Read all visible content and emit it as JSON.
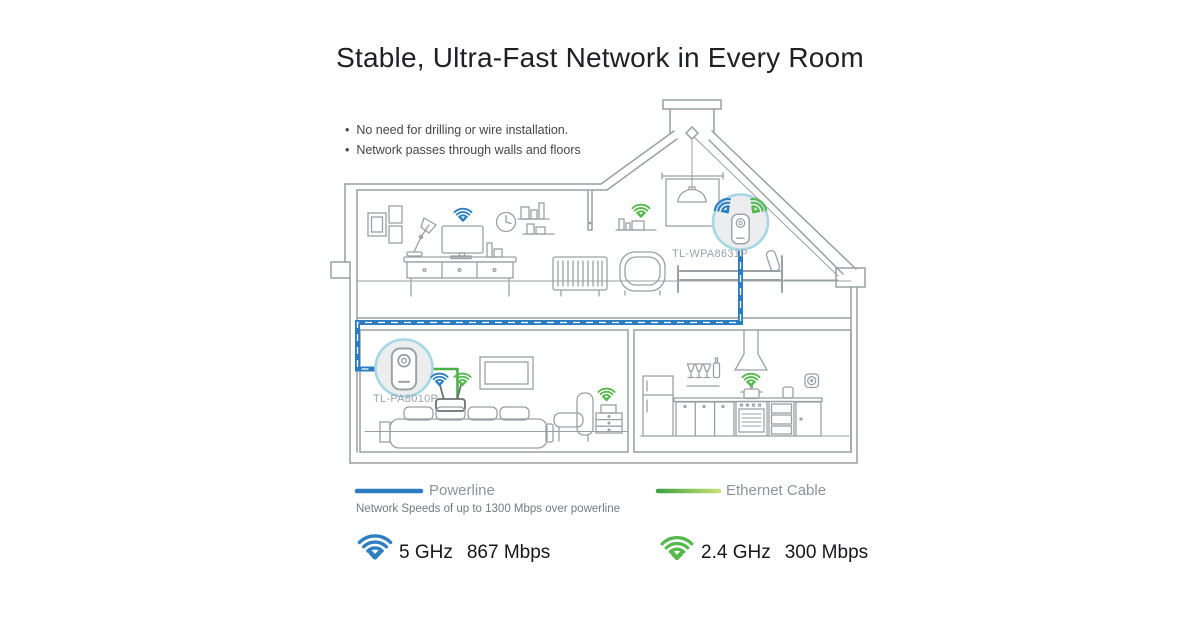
{
  "title": "Stable, Ultra-Fast Network in Every Room",
  "bullets": [
    "No need for drilling or wire installation.",
    "Network passes through walls and floors"
  ],
  "house": {
    "attic_device_label": "TL-WPA8631P",
    "bedroom_device_label": "TL-PA8010P"
  },
  "legend": {
    "powerline_label": "Powerline",
    "powerline_note": "Network Speeds of up to 1300 Mbps over powerline",
    "ethernet_label": "Ethernet Cable"
  },
  "speeds": [
    {
      "band": "5 GHz",
      "rate": "867 Mbps"
    },
    {
      "band": "2.4 GHz",
      "rate": "300 Mbps"
    }
  ],
  "icons": {
    "wifi": "wifi-arcs-with-down-chevron",
    "powerline_adapter": "wall-plug-device-in-circle",
    "power_outlet": "round-socket"
  },
  "colors": {
    "powerline_blue": "#2b7cc0",
    "wifi_blue": "#2e7fc2",
    "wifi_green": "#55b94c",
    "ethernet_gradient_start": "#3fa244",
    "ethernet_gradient_end": "#c8df72",
    "line_gray": "#98a0a4",
    "device_circle_fill": "#ebedee",
    "device_circle_border": "#a6d7e2",
    "title_text": "#202027",
    "muted_text": "#8d9499"
  }
}
